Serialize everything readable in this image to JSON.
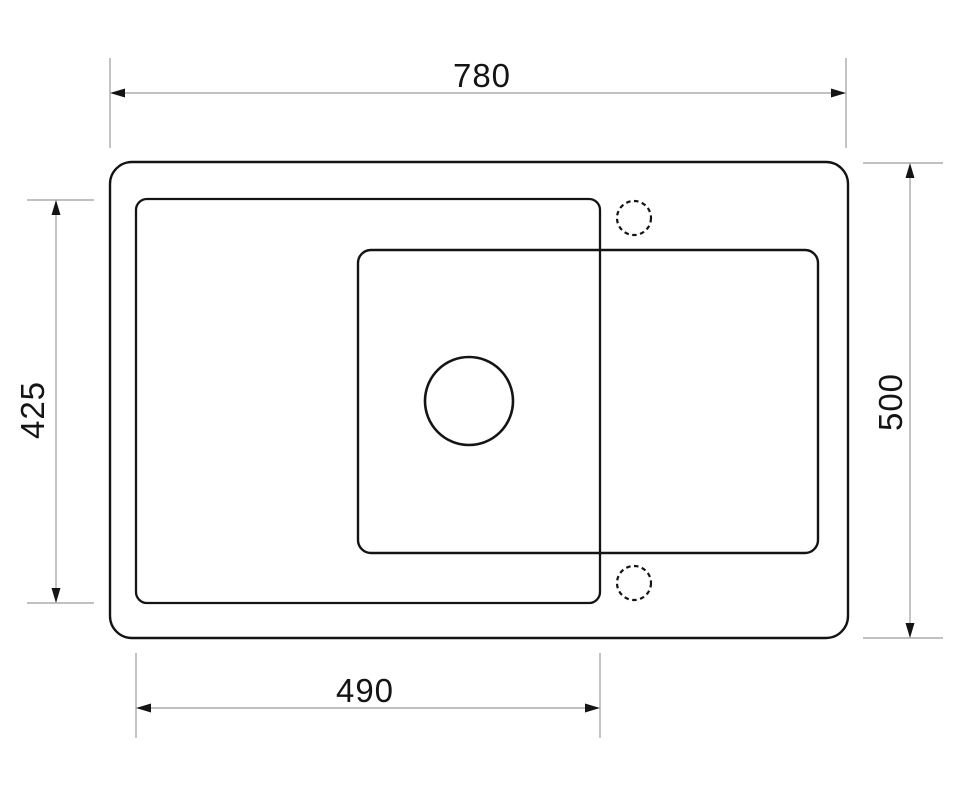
{
  "diagram": {
    "dimensions": {
      "top": "780",
      "bottom": "490",
      "left": "425",
      "right": "500"
    },
    "colors": {
      "background": "#ffffff",
      "outline": "#141414",
      "dimension_line": "#9c9c9c",
      "arrow": "#141414",
      "label_text": "#141414"
    }
  }
}
